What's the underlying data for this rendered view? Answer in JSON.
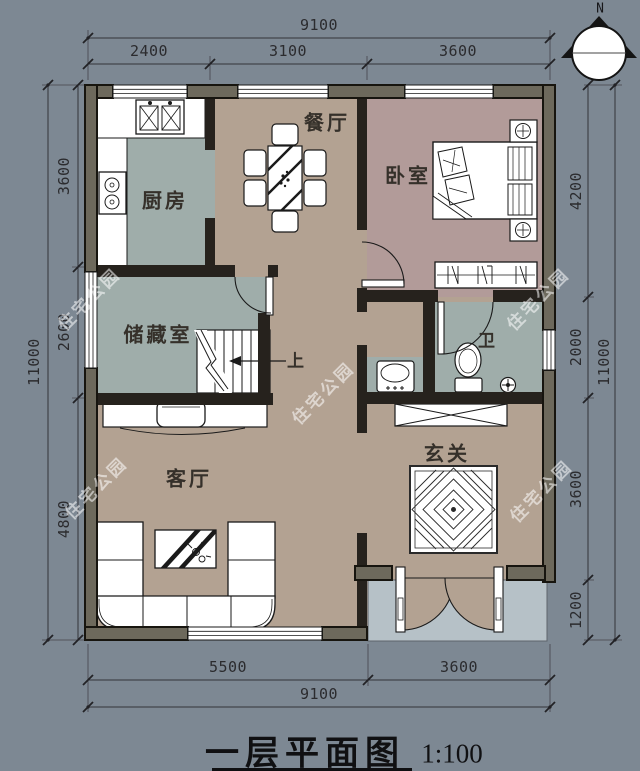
{
  "title": {
    "text": "一层平面图",
    "scale": "1:100"
  },
  "compass": {
    "label": "N"
  },
  "watermark": {
    "text": "住宅公园"
  },
  "rooms": [
    {
      "id": "kitchen",
      "label": "厨房"
    },
    {
      "id": "dining",
      "label": "餐厅"
    },
    {
      "id": "bedroom",
      "label": "卧室"
    },
    {
      "id": "storage",
      "label": "储藏室"
    },
    {
      "id": "bath",
      "label": "卫"
    },
    {
      "id": "living",
      "label": "客厅"
    },
    {
      "id": "entry",
      "label": "玄关"
    }
  ],
  "stairs": {
    "up_label": "上"
  },
  "dimensions": {
    "top": {
      "overall": "9100",
      "segments": [
        "2400",
        "3100",
        "3600"
      ]
    },
    "bottom": {
      "overall": "9100",
      "segments": [
        "5500",
        "3600"
      ]
    },
    "left": {
      "overall": "11000",
      "segments": [
        "3600",
        "2600",
        "4800"
      ]
    },
    "right": {
      "overall": "11000",
      "segments": [
        "4200",
        "2000",
        "3600",
        "1200"
      ]
    }
  },
  "colors": {
    "background": "#7d8893",
    "wall_fill": "#6d695c",
    "wall_line": "#17150f",
    "floor_warm": "#b3a292",
    "floor_bedroom": "#b29b99",
    "floor_cool": "#9fadaa",
    "porch": "#b6c1c7",
    "furniture": "#ffffff"
  }
}
